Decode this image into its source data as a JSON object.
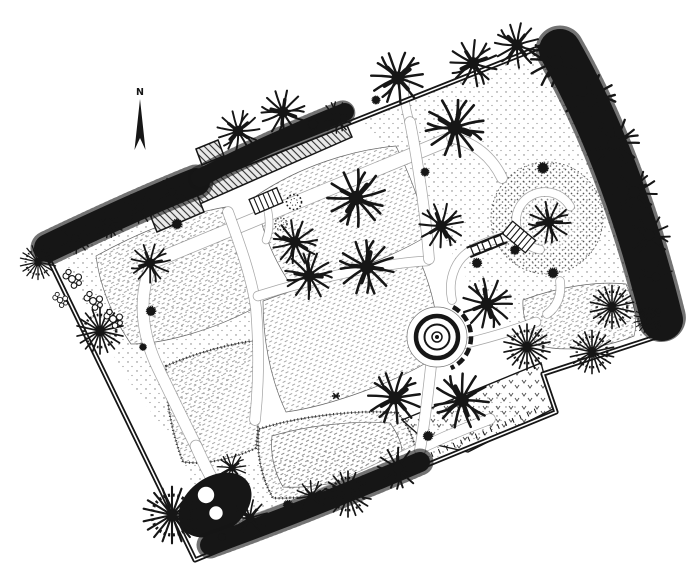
{
  "compass": {
    "label": "N"
  },
  "colors": {
    "ink": "#161616",
    "paper": "#ffffff"
  },
  "plan": {
    "boundary": "M42 245 L563 38 L668 333 L543 374 L556 412 L195 560 Z",
    "ground": [
      {
        "d": "M357 119 C440 84 520 52 556 44 C600 142 646 256 659 330 C610 348 562 350 526 336 C482 313 452 262 432 207 C412 166 382 140 357 119 Z"
      },
      {
        "d": "M62 252 C122 227 172 216 222 212 C241 262 252 302 256 346 C231 391 203 431 187 455 C152 421 92 332 62 252 Z"
      },
      {
        "d": "M182 462 C242 471 322 456 402 427 C442 412 477 398 508 392 C518 406 518 415 513 420 C430 462 322 512 242 536 C212 516 192 489 182 462 Z"
      }
    ],
    "lawns": [
      {
        "d": "M96 256 C150 226 196 212 226 207 C244 250 255 284 258 306 C214 330 164 344 131 344 C110 314 99 281 96 256 Z"
      },
      {
        "d": "M256 196 C300 166 352 150 396 146 C414 184 424 214 427 236 C388 260 328 280 291 285 C271 256 259 222 256 196 Z"
      },
      {
        "d": "M263 301 C330 276 392 263 421 263 C436 300 440 330 437 356 C400 381 330 406 286 412 C269 376 263 336 263 301 Z"
      },
      {
        "d": "M166 366 C200 351 236 343 253 341 C258 380 260 420 256 448 C231 460 201 465 183 462 C171 431 165 396 166 366 Z",
        "edge": true
      },
      {
        "d": "M259 429 C300 416 360 409 398 413 C412 431 418 448 414 462 C379 486 310 500 273 498 C261 478 256 451 259 429 Z",
        "edge": true
      },
      {
        "d": "M272 436 C305 426 355 420 390 423 C400 437 404 449 401 459 C372 478 315 489 283 487 C274 472 270 452 272 436 Z"
      },
      {
        "d": "M523 300 C560 286 600 281 626 284 C635 305 638 322 634 336 C600 350 561 352 537 345 C527 330 522 315 523 300 Z"
      }
    ],
    "bed": {
      "d": "M402 420 L541 363 L553 409 L468 452 L428 443 Z"
    },
    "mound_circles": [
      {
        "x": 547,
        "y": 218,
        "r": 56,
        "f": "url(#dotsD)",
        "s": "#666",
        "w": 1,
        "dash": "1.5 2.5"
      },
      {
        "x": 547,
        "y": 218,
        "r": 34,
        "f": "#ffffff",
        "op": 0.3
      }
    ],
    "paths": [
      {
        "d": "M152 262 L450 139",
        "w": 13
      },
      {
        "d": "M452 138 C474 142 492 157 502 178",
        "w": 10
      },
      {
        "d": "M150 268 C138 300 142 335 158 368 C170 393 182 418 196 446",
        "w": 11
      },
      {
        "d": "M196 446 C210 478 225 505 248 522",
        "w": 11
      },
      {
        "d": "M248 522 C310 500 360 478 400 458 C430 443 460 430 490 419",
        "w": 10
      },
      {
        "d": "M228 212 C240 245 252 278 256 308 C259 345 259 382 255 420",
        "w": 10
      },
      {
        "d": "M258 296 C315 278 385 263 427 261",
        "w": 9
      },
      {
        "d": "M431 366 C428 394 425 420 420 450",
        "w": 10
      },
      {
        "d": "M463 344 C492 337 515 330 536 322",
        "w": 9
      },
      {
        "d": "M410 124 C405 106 403 94 405 83",
        "w": 8
      },
      {
        "d": "M410 122 C416 152 421 186 425 217 C427 234 428 247 429 259",
        "w": 10
      },
      {
        "d": "M452 300 C448 281 454 263 467 253 C479 244 494 239 508 237",
        "w": 8
      },
      {
        "d": "M560 281 C562 295 557 307 547 314",
        "w": 8
      },
      {
        "d": "M267 207 C270 219 270 230 266 240",
        "w": 7
      },
      {
        "d": "M540 249.6 A29 29 0 1 1 570.1 206.5",
        "w": 8
      }
    ],
    "dark": [
      {
        "d": "M453 307 A34 34 0 0 1 450.8 368.1",
        "w": 4.5,
        "dash": "8 4"
      },
      {
        "d": "M203 551 L540 409",
        "w": 5,
        "dash": "1 7"
      }
    ],
    "circles": [
      {
        "x": 437,
        "y": 337,
        "r": 30,
        "f": "#ffffff",
        "s": "#777",
        "w": 0.7
      },
      {
        "x": 437,
        "y": 337,
        "r": 21,
        "f": "#ffffff",
        "s": "#161616",
        "w": 4.5
      },
      {
        "x": 437,
        "y": 337,
        "r": 12.5,
        "f": "none",
        "s": "#161616",
        "w": 2
      },
      {
        "x": 437,
        "y": 337,
        "r": 5,
        "f": "#ffffff",
        "s": "#161616",
        "w": 1.5
      },
      {
        "x": 437,
        "y": 337,
        "r": 2,
        "f": "#161616"
      }
    ],
    "building": {
      "blocks": [
        "M183 177 L340 109 L352 137 L195 206 Z",
        "M149 212 L196 192 L204 212 L157 232 Z",
        "M196 149 L218 140 L224 156 L202 165 Z"
      ]
    },
    "darkbed": {
      "x": 215,
      "y": 505,
      "rx": 40,
      "ry": 28,
      "a": -35
    },
    "wshrubs": [
      {
        "x": 206,
        "y": 495,
        "r": 9
      },
      {
        "x": 216,
        "y": 513,
        "r": 7.5
      }
    ],
    "bands": [
      {
        "d": "M48 248 C90 228 150 200 196 182",
        "w": 28
      },
      {
        "d": "M200 178 C250 152 300 130 345 112",
        "w": 18
      },
      {
        "d": "M560 50 C600 120 635 210 662 320",
        "w": 42
      },
      {
        "d": "M210 545 C280 520 350 492 420 462",
        "w": 20
      }
    ],
    "structures": [
      {
        "sym": "steps",
        "x": 266,
        "y": 201,
        "a": -23
      },
      {
        "sym": "steps",
        "x": 519,
        "y": 237,
        "a": 40
      },
      {
        "sym": "bridge",
        "x": 487,
        "y": 245,
        "a": -22
      }
    ],
    "trees": [
      {
        "t": "d",
        "x": 75,
        "y": 238,
        "s": 0.6
      },
      {
        "t": "d",
        "x": 108,
        "y": 222,
        "s": 0.6,
        "a": 45
      },
      {
        "t": "d",
        "x": 140,
        "y": 207,
        "s": 0.6,
        "a": 110
      },
      {
        "t": "d",
        "x": 172,
        "y": 192,
        "s": 0.55,
        "a": 200
      },
      {
        "t": "d",
        "x": 150,
        "y": 263,
        "s": 0.75,
        "a": 40
      },
      {
        "t": "s",
        "x": 177,
        "y": 224,
        "s": 0.42
      },
      {
        "t": "d",
        "x": 238,
        "y": 131,
        "s": 0.8,
        "a": 10
      },
      {
        "t": "d",
        "x": 283,
        "y": 112,
        "s": 0.85,
        "a": 70
      },
      {
        "t": "s",
        "x": 313,
        "y": 124,
        "s": 0.45
      },
      {
        "t": "d",
        "x": 337,
        "y": 117,
        "s": 0.6,
        "a": 140
      },
      {
        "t": "d",
        "x": 398,
        "y": 78,
        "s": 1.0,
        "a": 200
      },
      {
        "t": "s",
        "x": 376,
        "y": 100,
        "s": 0.35
      },
      {
        "t": "d",
        "x": 473,
        "y": 63,
        "s": 0.9,
        "a": 30
      },
      {
        "t": "d",
        "x": 517,
        "y": 45,
        "s": 0.85,
        "a": 100
      },
      {
        "t": "d",
        "x": 556,
        "y": 62,
        "s": 1.0,
        "a": 170
      },
      {
        "t": "d",
        "x": 590,
        "y": 100,
        "s": 1.0,
        "a": 240
      },
      {
        "t": "d",
        "x": 614,
        "y": 143,
        "s": 0.95,
        "a": 310
      },
      {
        "t": "d",
        "x": 455,
        "y": 128,
        "s": 1.12,
        "a": 260
      },
      {
        "t": "d",
        "x": 634,
        "y": 192,
        "s": 0.85,
        "a": 20
      },
      {
        "t": "d",
        "x": 649,
        "y": 235,
        "s": 0.8,
        "a": 90
      },
      {
        "t": "d",
        "x": 656,
        "y": 277,
        "s": 0.65,
        "a": 160
      },
      {
        "t": "p",
        "x": 612,
        "y": 307,
        "s": 0.8
      },
      {
        "t": "p",
        "x": 649,
        "y": 319,
        "s": 0.55
      },
      {
        "t": "p",
        "x": 38,
        "y": 262,
        "s": 0.65
      },
      {
        "t": "p",
        "x": 100,
        "y": 331,
        "s": 0.85
      },
      {
        "t": "s",
        "x": 151,
        "y": 311,
        "s": 0.4
      },
      {
        "t": "s",
        "x": 143,
        "y": 347,
        "s": 0.3
      },
      {
        "t": "f",
        "x": 72,
        "y": 279,
        "s": 1
      },
      {
        "t": "f",
        "x": 93,
        "y": 301,
        "s": 1
      },
      {
        "t": "f",
        "x": 113,
        "y": 319,
        "s": 1
      },
      {
        "t": "f",
        "x": 60,
        "y": 300,
        "s": 0.8
      },
      {
        "t": "o",
        "x": 294,
        "y": 202,
        "s": 1
      },
      {
        "t": "o",
        "x": 281,
        "y": 224,
        "s": 0.8
      },
      {
        "t": "d",
        "x": 356,
        "y": 198,
        "s": 1.1,
        "a": 0
      },
      {
        "t": "d",
        "x": 295,
        "y": 242,
        "s": 0.85,
        "a": 80
      },
      {
        "t": "d",
        "x": 367,
        "y": 267,
        "s": 1.05,
        "a": 160
      },
      {
        "t": "d",
        "x": 309,
        "y": 276,
        "s": 0.9,
        "a": 240
      },
      {
        "t": "s",
        "x": 425,
        "y": 172,
        "s": 0.35
      },
      {
        "t": "d",
        "x": 441,
        "y": 226,
        "s": 0.85,
        "a": 300
      },
      {
        "t": "d",
        "x": 549,
        "y": 222,
        "s": 0.8,
        "a": 50
      },
      {
        "t": "s",
        "x": 543,
        "y": 168,
        "s": 0.45
      },
      {
        "t": "s",
        "x": 515,
        "y": 250,
        "s": 0.38
      },
      {
        "t": "s",
        "x": 553,
        "y": 273,
        "s": 0.42
      },
      {
        "t": "s",
        "x": 477,
        "y": 263,
        "s": 0.4
      },
      {
        "t": "d",
        "x": 487,
        "y": 304,
        "s": 0.95,
        "a": 310
      },
      {
        "t": "p",
        "x": 527,
        "y": 347,
        "s": 0.85
      },
      {
        "t": "p",
        "x": 592,
        "y": 352,
        "s": 0.8
      },
      {
        "t": "d",
        "x": 462,
        "y": 400,
        "s": 1.05,
        "a": 120
      },
      {
        "t": "s",
        "x": 428,
        "y": 436,
        "s": 0.4
      },
      {
        "t": "d",
        "x": 395,
        "y": 398,
        "s": 1.0,
        "a": 200
      },
      {
        "t": "d",
        "x": 398,
        "y": 468,
        "s": 0.8,
        "a": 60
      },
      {
        "t": "p",
        "x": 348,
        "y": 494,
        "s": 0.85
      },
      {
        "t": "d",
        "x": 312,
        "y": 496,
        "s": 0.6,
        "a": 20
      },
      {
        "t": "s",
        "x": 288,
        "y": 505,
        "s": 0.4
      },
      {
        "t": "d",
        "x": 250,
        "y": 518,
        "s": 0.7,
        "a": 100
      },
      {
        "t": "s",
        "x": 222,
        "y": 537,
        "s": 0.35
      },
      {
        "t": "p",
        "x": 172,
        "y": 515,
        "s": 1.05
      },
      {
        "t": "d",
        "x": 232,
        "y": 468,
        "s": 0.55,
        "a": 200
      },
      {
        "t": "a",
        "x": 336,
        "y": 396,
        "s": 1
      }
    ]
  }
}
